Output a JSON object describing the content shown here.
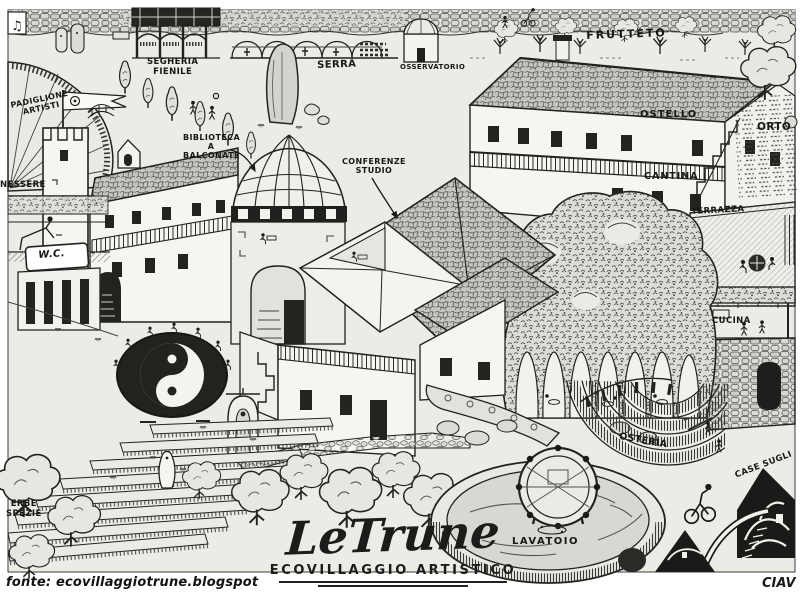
{
  "title": {
    "name": "LeTrune",
    "subtitle": "ECOVILLAGGIO ARTISTICO"
  },
  "meta": {
    "source_credit": "fonte: ecovillaggiotrune.blogspot",
    "signature": "CIAV"
  },
  "labels": {
    "padiglione": "PADIGLIONE\nARTISTI",
    "segheria": "SEGHERIA\nFIENILE",
    "serra": "SERRA",
    "osservatorio": "OSSERVATORIO",
    "frutteto": "FRUTTETO",
    "ostello": "OSTELLO",
    "orto": "ORTO",
    "cantina": "CANTINA",
    "terrazza": "TERRAZZA",
    "cucina": "CUCINA",
    "biblioteca": "BIBLIOTECA\nA BALCONATE",
    "conferenze": "CONFERENZE\nSTUDIO",
    "benessere": "NESSERE",
    "wc": "W.C.",
    "erbe": "ERBE\nSPEZIE",
    "osteria": "OSTERIA",
    "lavatoio": "LAVATOIO",
    "case_sugli": "CASE SUGLI"
  },
  "icons": {
    "music_note": "♫"
  },
  "colors": {
    "ink": "#1b1a18",
    "paper": "#ecebe6",
    "roof_gray": "#c6c5c0",
    "water_gray": "#d8d8d3",
    "dark_fill": "#1f1e1c"
  }
}
